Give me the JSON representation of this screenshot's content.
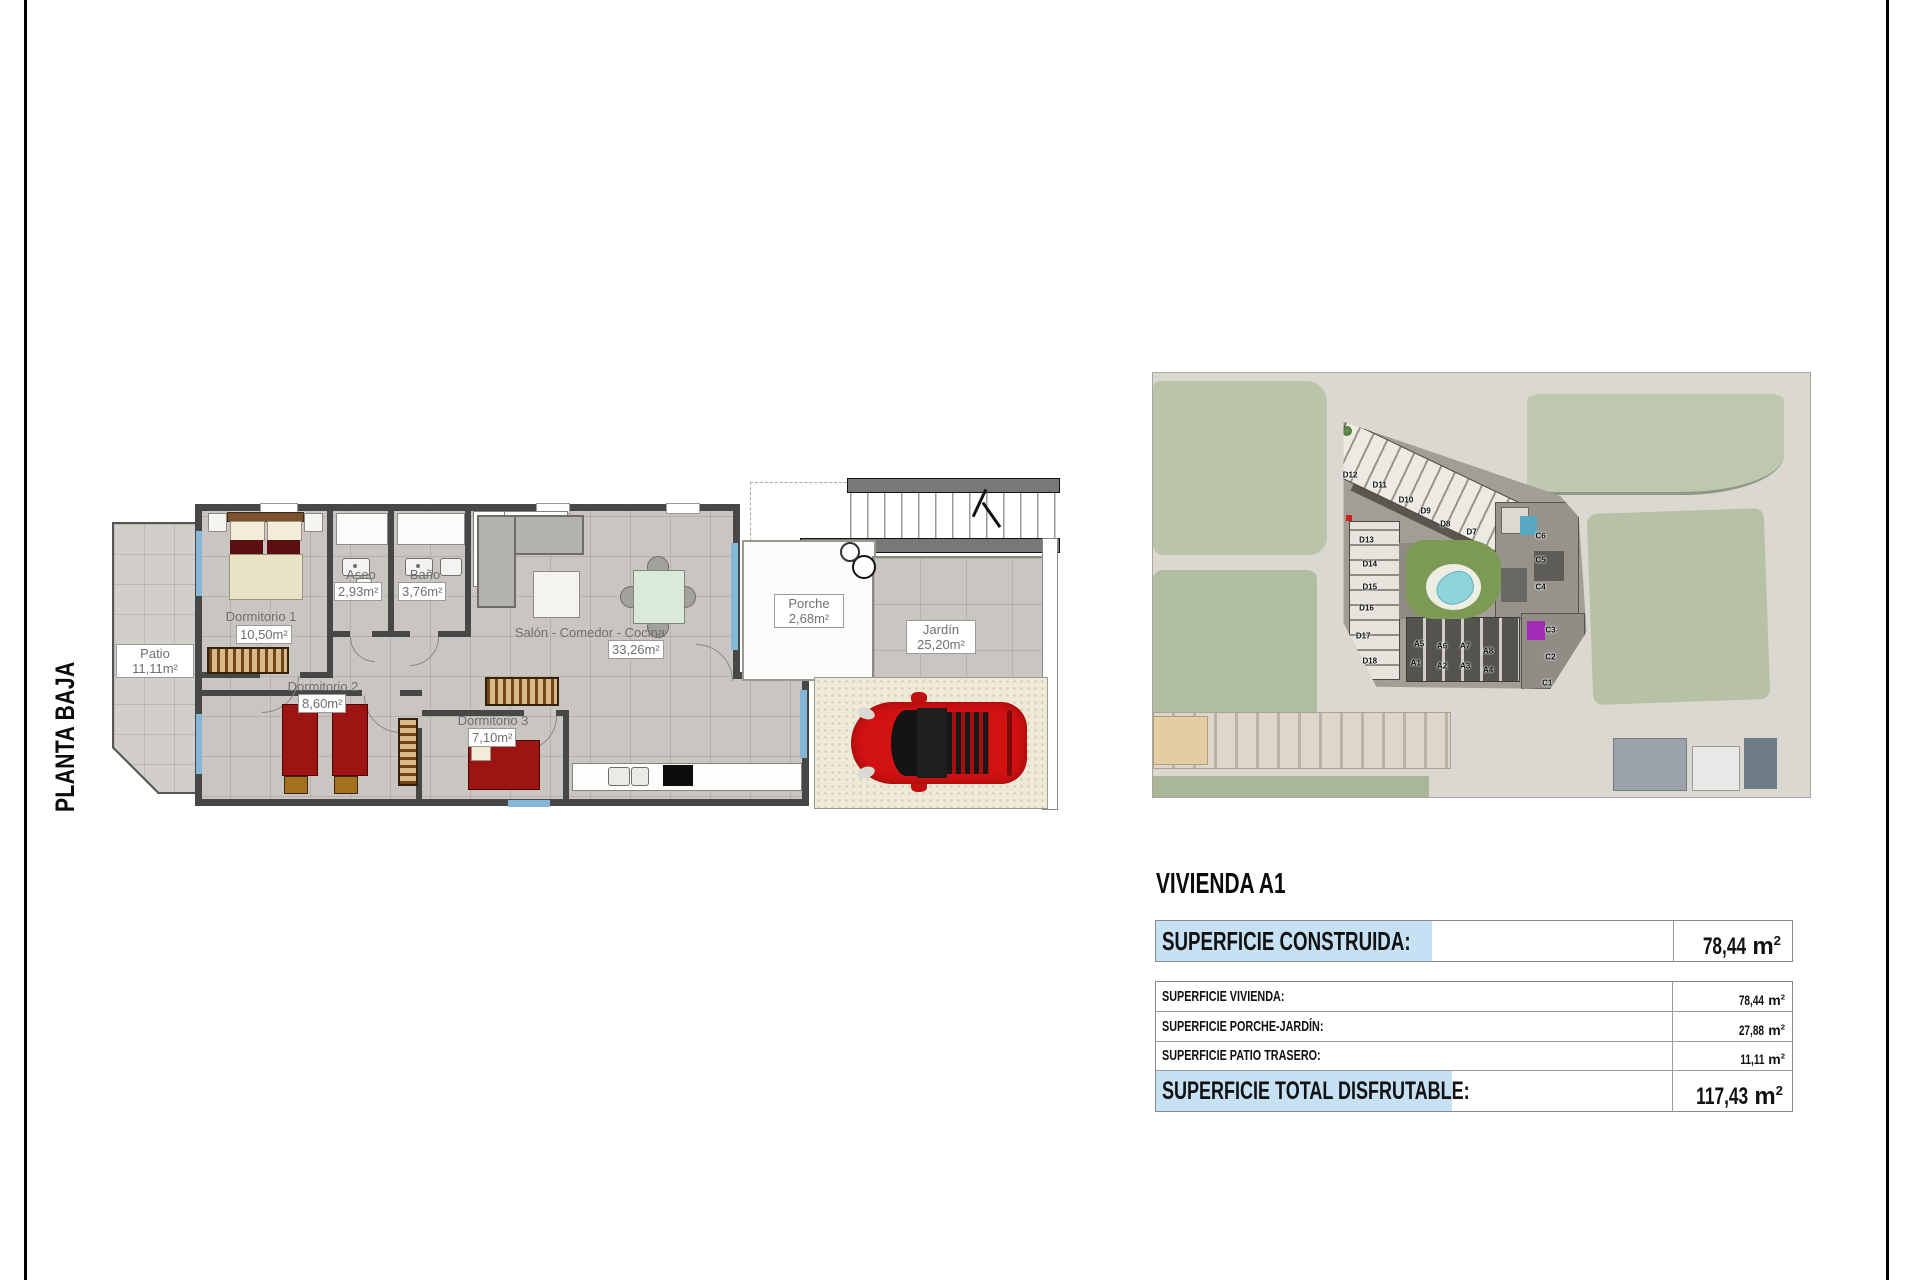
{
  "page": {
    "sheet_label": "PLANTA BAJA"
  },
  "colors": {
    "highlight_blue": "#c6e1f4",
    "wall_gray": "#474747",
    "car_red": "#d31212"
  },
  "floor_plan": {
    "rooms": [
      {
        "id": "patio",
        "name": "Patio",
        "area": "11,11m²"
      },
      {
        "id": "dormitorio1",
        "name": "Dormitorio 1",
        "area": "10,50m²"
      },
      {
        "id": "aseo",
        "name": "Aseo",
        "area": "2,93m²"
      },
      {
        "id": "bano",
        "name": "Baño",
        "area": "3,76m²"
      },
      {
        "id": "salon",
        "name": "Salón - Comedor - Cocina",
        "area": "33,26m²"
      },
      {
        "id": "dormitorio2",
        "name": "Dormitorio 2",
        "area": "8,60m²"
      },
      {
        "id": "dormitorio3",
        "name": "Dormitorio 3",
        "area": "7,10m²"
      },
      {
        "id": "porche",
        "name": "Porche",
        "area": "2,68m²"
      },
      {
        "id": "jardin",
        "name": "Jardín",
        "area": "25,20m²"
      }
    ]
  },
  "site_plan": {
    "unit_labels": [
      {
        "label": "D12",
        "x": 30,
        "y": 24
      },
      {
        "label": "D11",
        "x": 34.5,
        "y": 26.5
      },
      {
        "label": "D10",
        "x": 38.5,
        "y": 30
      },
      {
        "label": "D9",
        "x": 41.5,
        "y": 32.5
      },
      {
        "label": "D8",
        "x": 44.5,
        "y": 35.5
      },
      {
        "label": "D7",
        "x": 48.5,
        "y": 37.5
      },
      {
        "label": "D13",
        "x": 32.5,
        "y": 39.5
      },
      {
        "label": "D14",
        "x": 33,
        "y": 45
      },
      {
        "label": "D15",
        "x": 33,
        "y": 50.5
      },
      {
        "label": "D16",
        "x": 32.5,
        "y": 55.5
      },
      {
        "label": "D17",
        "x": 32,
        "y": 62
      },
      {
        "label": "D18",
        "x": 33,
        "y": 68
      },
      {
        "label": "C6",
        "x": 59,
        "y": 38.5
      },
      {
        "label": "C5",
        "x": 59,
        "y": 44
      },
      {
        "label": "C4",
        "x": 59,
        "y": 50.5
      },
      {
        "label": "C3",
        "x": 60.5,
        "y": 60.5
      },
      {
        "label": "C2",
        "x": 60.5,
        "y": 67
      },
      {
        "label": "C1",
        "x": 60,
        "y": 73
      },
      {
        "label": "A5",
        "x": 40.5,
        "y": 64
      },
      {
        "label": "A6",
        "x": 44,
        "y": 64.5
      },
      {
        "label": "A7",
        "x": 47.5,
        "y": 64.5
      },
      {
        "label": "A8",
        "x": 51,
        "y": 65.5
      },
      {
        "label": "A1",
        "x": 40,
        "y": 68.5
      },
      {
        "label": "A2",
        "x": 44,
        "y": 69
      },
      {
        "label": "A3",
        "x": 47.5,
        "y": 69
      },
      {
        "label": "A4",
        "x": 51,
        "y": 70
      }
    ]
  },
  "summary": {
    "title": "VIVIENDA A1",
    "units": {
      "m": "m",
      "exp": "2"
    },
    "construida": {
      "label": "SUPERFICIE CONSTRUIDA:",
      "value": "78,44"
    },
    "rows": [
      {
        "label": "SUPERFICIE VIVIENDA:",
        "value": "78,44"
      },
      {
        "label": "SUPERFICIE PORCHE-JARDÍN:",
        "value": "27,88"
      },
      {
        "label": "SUPERFICIE PATIO TRASERO:",
        "value": "11,11"
      }
    ],
    "total": {
      "label": "SUPERFICIE TOTAL DISFRUTABLE:",
      "value": "117,43"
    }
  }
}
